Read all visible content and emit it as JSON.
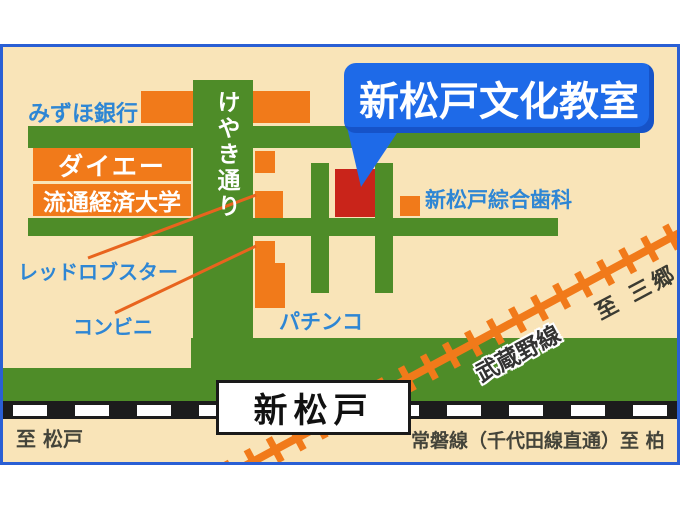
{
  "bubble": {
    "label": "新松戸文化教室"
  },
  "station": {
    "label": "新松戸"
  },
  "streets": {
    "keyaki": "けやき通り"
  },
  "places": {
    "mizuho_bank": "みずほ銀行",
    "daiei": "ダイエー",
    "ryutsu_keizai_university": "流通経済大学",
    "red_lobster": "レッドロブスター",
    "convenience_store": "コンビニ",
    "pachinko": "パチンコ",
    "dental_clinic": "新松戸綜合歯科"
  },
  "railways": {
    "musashino_line": "武蔵野線",
    "to_misato": "至 三郷",
    "joban_line_to_kashiwa": "常磐線（千代田線直通）至 柏",
    "to_matsudo": "至 松戸"
  },
  "colors": {
    "map_background": "#F9E4B8",
    "road_green": "#4E8C28",
    "building_orange": "#F17A1A",
    "classroom_red": "#C9241A",
    "bubble_blue": "#1E6AE8",
    "label_blue": "#2E86D4",
    "frame_blue": "#2A5FD4",
    "railway_black": "#1C1C1C",
    "railway_orange": "#F17A1A",
    "dark_text": "#44443A"
  }
}
